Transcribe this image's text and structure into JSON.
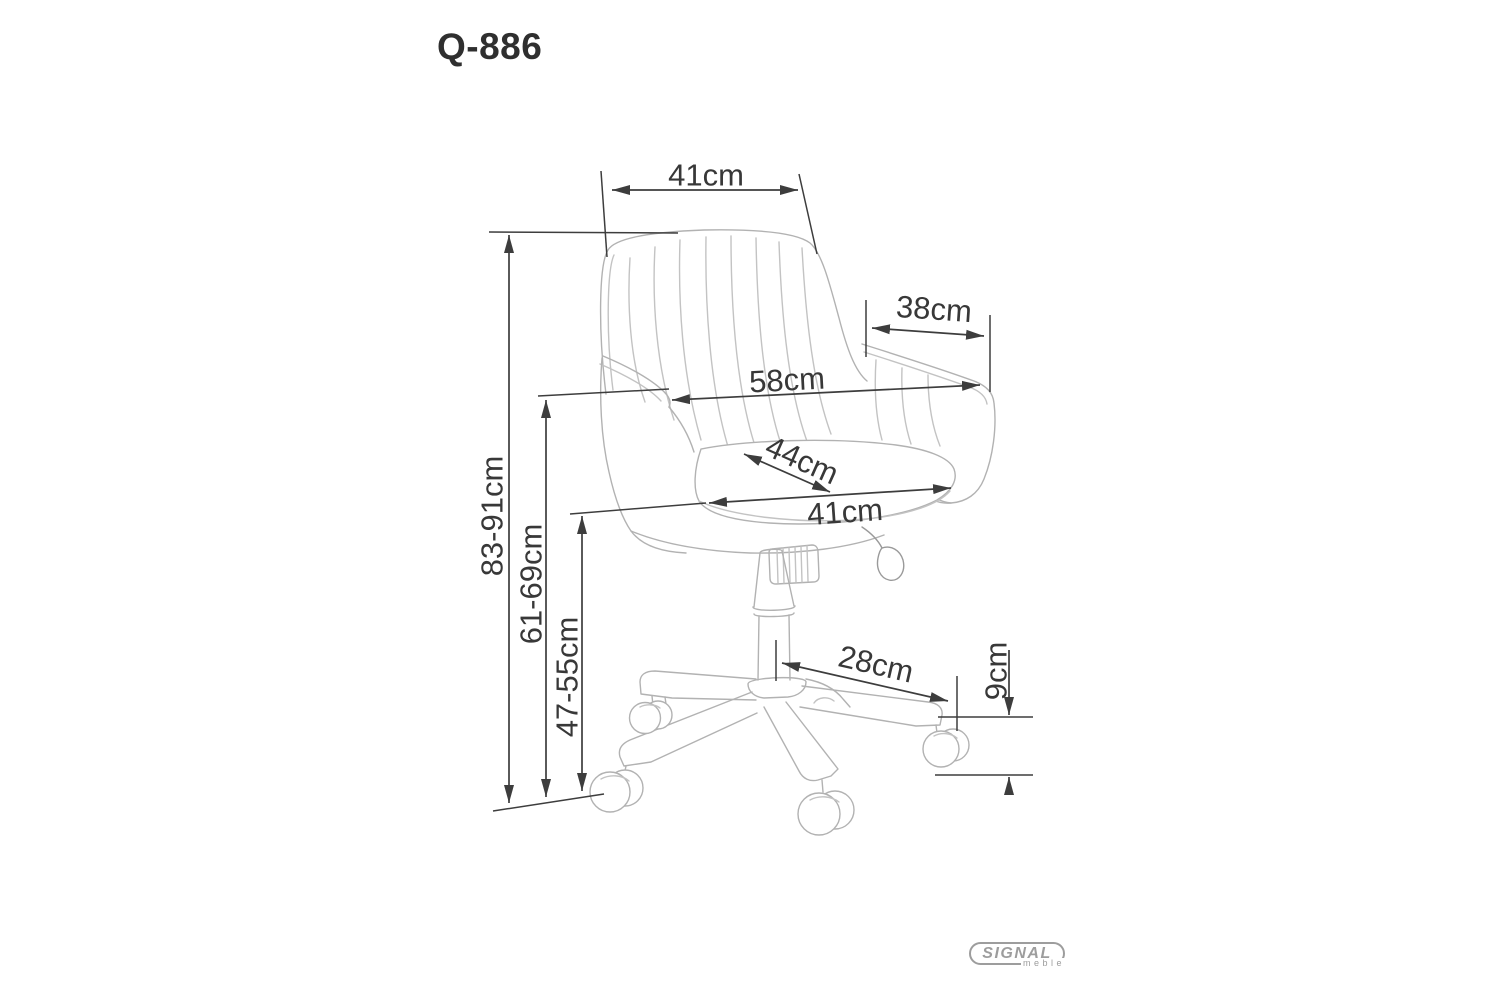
{
  "title": "Q-886",
  "dimensions": {
    "backrest_width": "41cm",
    "armrest_depth": "38cm",
    "overall_width": "58cm",
    "seat_depth": "44cm",
    "seat_width": "41cm",
    "overall_height": "83-91cm",
    "armrest_height": "61-69cm",
    "seat_height": "47-55cm",
    "base_arm_span": "28cm",
    "caster_height": "9cm"
  },
  "logo": {
    "brand": "SIGNAL",
    "subtitle": "meble"
  },
  "colors": {
    "dimension_lines": "#3d3d3d",
    "drawing_lines": "#b2b2b2",
    "logo_gray": "#9d9d9d",
    "background": "#ffffff"
  }
}
